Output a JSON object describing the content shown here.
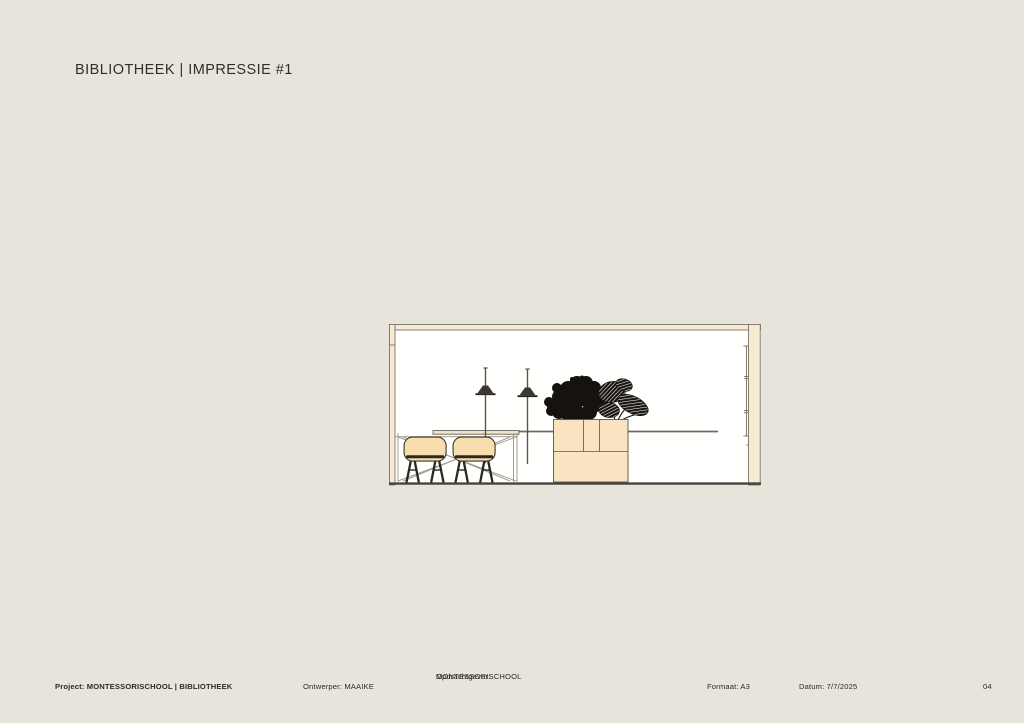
{
  "title": "BIBLIOTHEEK | IMPRESSIE #1",
  "footer": {
    "project": "Project: MONTESSORISCHOOL | BIBLIOTHEEK",
    "ontwerper": "Ontwerper: MAAIKE",
    "opdrachtgever_label": "Opdrachtgever:",
    "opdrachtgever_value": "MONTESSORISCHOOL",
    "formaat": "Formaat: A3",
    "datum": "Datum: 7/7/2025",
    "page_number": "04"
  },
  "drawing": {
    "description": "Interior elevation: long desk with wire-base table and two shell chairs, two slim floor lamps, plant cabinet with foliage, walls in section",
    "colors": {
      "page_background": "#e8e3db",
      "paper_white": "#fffffe",
      "wood_fill": "#fae3c1",
      "wall_fill": "#f5ead2",
      "chair_shell": "#f8ddae",
      "outline_dark": "#55504a",
      "frame_gray": "#a39d92",
      "foliage_black": "#151210"
    }
  }
}
